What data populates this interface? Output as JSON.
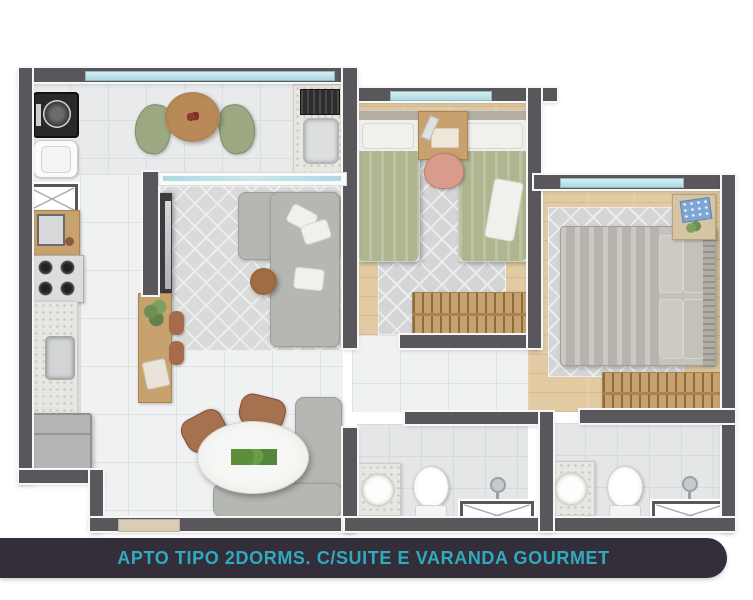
{
  "caption": {
    "label": "APTO TIPO 2DORMS. C/SUITE E VARANDA GOURMET"
  },
  "palette": {
    "wall": "#59575b",
    "wall_edge": "#f7f7f7",
    "tile": "#eff1f2",
    "balcony": "#e8eaeb",
    "bath": "#e4e6e8",
    "wood": "#e2cba3",
    "rug": "#d4d5d7",
    "green_bed": "#aeb690",
    "gray_bed": "#b7b4ae",
    "sofa": "#b4b7b2",
    "woodfurn": "#c8a26e",
    "glass": "#aed9e2",
    "terrazzo": "#e8e6e1",
    "brown": "#a6714e",
    "dark_appliance": "#29292b",
    "bar_bg": "#332e39",
    "caption_text": "#2fabbf"
  },
  "floorplan": {
    "rooms": [
      {
        "name": "varanda-gourmet"
      },
      {
        "name": "kitchen"
      },
      {
        "name": "living-dining"
      },
      {
        "name": "bedroom-1"
      },
      {
        "name": "suite-bedroom"
      },
      {
        "name": "bathroom-1"
      },
      {
        "name": "suite-bathroom"
      }
    ],
    "fixtures": [
      "washing-machine",
      "laundry-tank",
      "duct-shaft",
      "balcony-table",
      "balcony-chairs",
      "grill-counter",
      "grill-sink",
      "stove",
      "kitchen-sink",
      "fridge",
      "tv-panel",
      "sideboard",
      "sofa",
      "coffee-table",
      "dining-table",
      "dining-chairs",
      "banquette",
      "twin-beds",
      "desk",
      "desk-chair",
      "wardrobes",
      "double-bed",
      "nightstand",
      "vanity-sinks",
      "toilets",
      "showers",
      "windows",
      "sliding-glass-door",
      "entry-door"
    ]
  }
}
